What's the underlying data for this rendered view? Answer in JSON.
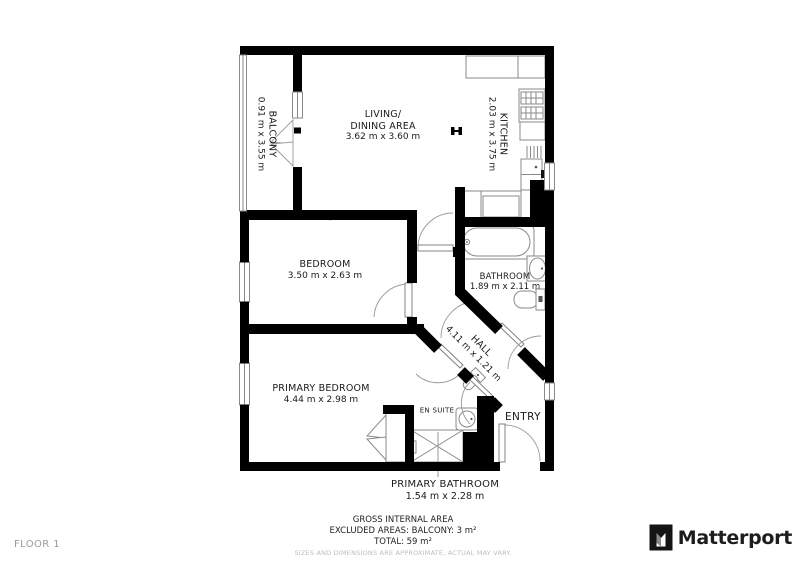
{
  "plan": {
    "floor_label": "FLOOR 1",
    "rooms": {
      "balcony": {
        "name": "BALCONY",
        "dims": "0.91 m x 3.55 m"
      },
      "living": {
        "name_line1": "LIVING/",
        "name_line2": "DINING AREA",
        "dims": "3.62 m x 3.60 m"
      },
      "kitchen": {
        "name": "KITCHEN",
        "dims": "2.03 m x 3.75 m"
      },
      "bedroom": {
        "name": "BEDROOM",
        "dims": "3.50 m x 2.63 m"
      },
      "bathroom": {
        "name": "BATHROOM",
        "dims": "1.89 m x 2.11 m"
      },
      "hall": {
        "name": "HALL",
        "dims": "4.11 m x 1.21 m"
      },
      "primary_bedroom": {
        "name": "PRIMARY BEDROOM",
        "dims": "4.44 m x 2.98 m"
      },
      "en_suite": {
        "name": "EN SUITE"
      },
      "entry": {
        "name": "ENTRY"
      },
      "primary_bathroom": {
        "name": "PRIMARY BATHROOM",
        "dims": "1.54 m x 2.28 m"
      }
    },
    "summary": {
      "line1": "GROSS INTERNAL AREA",
      "line2": "EXCLUDED AREAS: BALCONY: 3 m²",
      "line3": "TOTAL: 59 m²",
      "disclaimer": "SIZES AND DIMENSIONS ARE APPROXIMATE, ACTUAL MAY VARY."
    },
    "brand": {
      "name": "Matterport"
    },
    "colors": {
      "wall": "#000000",
      "fixture_line": "#8a8a8a",
      "text": "#1a1a1a",
      "muted": "#bdbdbd"
    }
  }
}
